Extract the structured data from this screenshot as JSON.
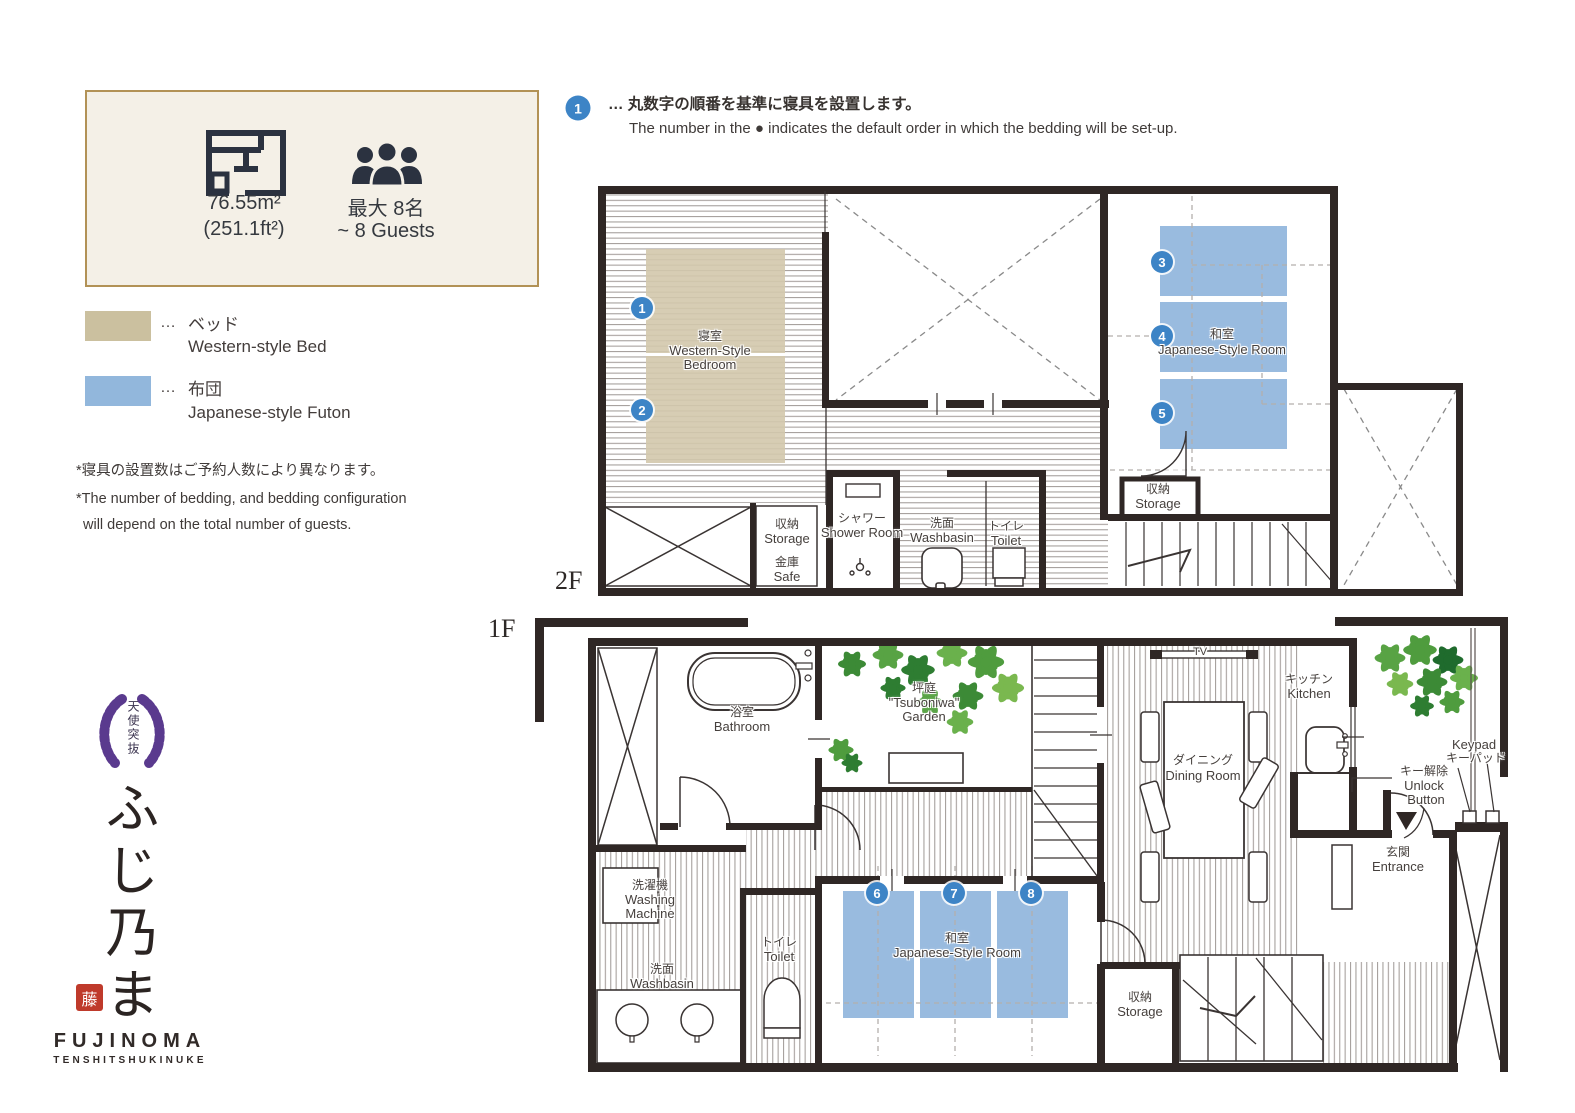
{
  "palette": {
    "wall": "#2f2725",
    "accent_blue": "#3d84c6",
    "futon": "#99bbdf",
    "bed": "#d3c8ac",
    "legend_bed": "#cbc09f",
    "legend_futon": "#92b7dc",
    "cream_bg": "#f4f0e7",
    "gold_border": "#b29256",
    "crest_purple": "#5a3a8e",
    "seal_red": "#bf3a2b",
    "leaf_green": "#4f9c3e"
  },
  "info_box": {
    "area_main": "76.55m²",
    "area_sub": "(251.1ft²)",
    "capacity_jp": "最大 8名",
    "capacity_en": "~ 8 Guests"
  },
  "legend": {
    "dots": "…",
    "bed_jp": "ベッド",
    "bed_en": "Western-style Bed",
    "futon_jp": "布団",
    "futon_en": "Japanese-style Futon"
  },
  "notes": {
    "jp": "*寝具の設置数はご予約人数により異なります。",
    "en_line1": "*The number of bedding, and bedding configuration",
    "en_line2": "will depend on the total number of guests."
  },
  "annotation": {
    "number": "1",
    "jp": "… 丸数字の順番を基準に寝具を設置します。",
    "en": "The number in the ● indicates the default order in which the bedding will be set-up."
  },
  "markers": [
    "1",
    "2",
    "3",
    "4",
    "5",
    "6",
    "7",
    "8"
  ],
  "f2": {
    "floor_label": "2F",
    "bedroom_jp": "寝室",
    "bedroom_en1": "Western-Style",
    "bedroom_en2": "Bedroom",
    "jroom_jp": "和室",
    "jroom_en": "Japanese-Style Room",
    "storage_jp": "収納",
    "storage_en": "Storage",
    "safe_jp": "金庫",
    "safe_en": "Safe",
    "shower_jp": "シャワー",
    "shower_en": "Shower Room",
    "wash_jp": "洗面",
    "wash_en": "Washbasin",
    "toilet_jp": "トイレ",
    "toilet_en": "Toilet",
    "storage2_jp": "収納",
    "storage2_en": "Storage"
  },
  "f1": {
    "floor_label": "1F",
    "bath_jp": "浴室",
    "bath_en": "Bathroom",
    "garden_jp": "坪庭",
    "garden_en1": "\"Tsuboniwa\"",
    "garden_en2": "Garden",
    "washing_jp": "洗濯機",
    "washing_en1": "Washing",
    "washing_en2": "Machine",
    "wash_jp": "洗面",
    "wash_en": "Washbasin",
    "toilet_jp": "トイレ",
    "toilet_en": "Toilet",
    "jroom_jp": "和室",
    "jroom_en": "Japanese-Style Room",
    "dining_jp": "ダイニング",
    "dining_en": "Dining Room",
    "kitchen_jp": "キッチン",
    "kitchen_en": "Kitchen",
    "tv": "TV",
    "entrance_jp": "玄関",
    "entrance_en": "Entrance",
    "storage_jp": "収納",
    "storage_en": "Storage",
    "unlock_jp": "キー解除",
    "unlock_en1": "Unlock",
    "unlock_en2": "Button",
    "keypad_en": "Keypad",
    "keypad_jp": "キーパッド"
  },
  "logo": {
    "crest_text": "天使突抜",
    "script": "ふじ乃ま",
    "seal": "藤",
    "name": "FUJINOMA",
    "subtitle": "TENSHITSHUKINUKE"
  }
}
